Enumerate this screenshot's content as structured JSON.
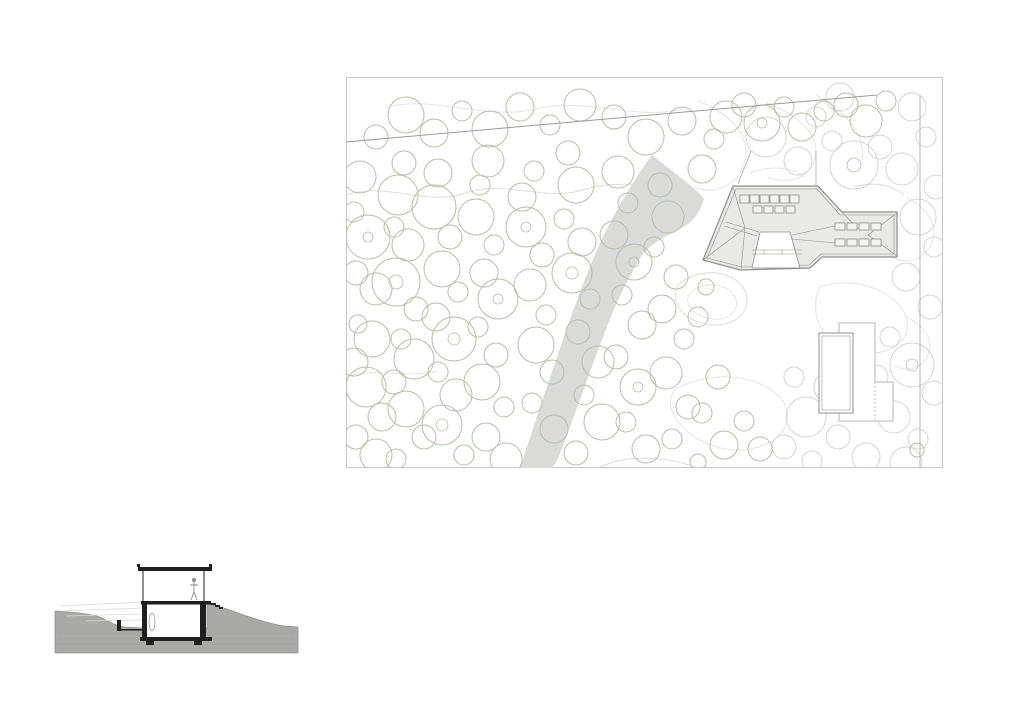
{
  "sheet": {
    "background": "#ffffff",
    "description_site_plan": "site-plan-with-trees-contours-driveway-buildings",
    "description_section": "building-cross-section-in-terrain"
  },
  "site_plan": {
    "colors": {
      "frame": "#c6c6c4",
      "contour": "#e4e4e0",
      "contour_dark": "#dcdcd8",
      "tree_green": "#b3c1a7",
      "tree_gray": "#d4d4d0",
      "driveway": "#dadad8",
      "building_fill": "#e9e9e7",
      "building_stroke": "#8f8f8d",
      "boundary": "#9a9a98",
      "thin_gray": "#b5b5b1",
      "skylight_fill": "#f4f4f2",
      "skylight_stroke": "#8d8d8b",
      "white": "#ffffff"
    },
    "frame_rect": [
      0.5,
      0.5,
      596,
      390
    ],
    "boundary_line": {
      "x1": 0,
      "y1": 65,
      "x2": 531,
      "y2": 18
    },
    "right_line": {
      "x1": 574,
      "y1": 18,
      "x2": 574,
      "y2": 391
    },
    "survey_circle": [
      571,
      373,
      7
    ],
    "driveway_path": "M 306 78 C 316 86 324 92 334 100 C 344 108 352 114 358 122 C 354 136 346 146 334 152 C 320 159 306 166 296 178 C 282 200 268 230 254 268 C 240 306 224 350 212 382 L 206 391 L 174 391 C 186 354 202 306 220 254 C 236 208 250 172 264 146 C 278 120 292 97 306 78 Z",
    "contours": [
      "M 0 118 C 40 104 80 130 120 116 C 160 102 200 126 240 112 C 272 102 300 112 330 104",
      "M 40 30 C 90 18 140 44 190 32 C 240 20 290 44 336 32",
      "M 352 24 C 392 40 408 66 396 92 C 388 110 366 118 348 110",
      "M 420 26 C 458 40 476 62 468 84 C 462 102 440 108 422 100",
      "M 470 18 C 500 34 520 58 516 84",
      "M 332 208 C 352 190 386 192 398 212 C 408 230 392 250 366 248 C 342 246 322 228 332 208 Z",
      "M 344 216 C 358 204 380 206 388 218 C 396 232 384 244 366 242 C 350 240 336 228 344 216 Z",
      "M 560 120 C 584 132 594 152 584 170 C 574 186 552 188 540 176",
      "M 474 210 C 506 200 540 210 556 232 C 570 252 556 274 528 276 C 498 278 472 258 470 236 C 469 224 470 216 474 210 Z",
      "M 330 312 C 362 294 408 296 432 318 C 452 338 440 366 404 372 C 368 378 334 356 326 334 C 323 325 324 318 330 312 Z",
      "M 252 391 C 282 376 322 380 352 391",
      "M 448 160 C 470 150 492 152 506 164",
      "M 404 96 C 424 88 446 90 458 100",
      "M 0 300 C 30 290 60 302 92 294",
      "M 560 240 C 578 248 588 262 582 278 C 576 292 560 296 548 288",
      "M 508 110 C 528 104 546 108 558 118"
    ],
    "trees_green": [
      [
        14,
        100,
        16
      ],
      [
        8,
        135,
        10
      ],
      [
        22,
        160,
        22
      ],
      [
        10,
        196,
        12
      ],
      [
        30,
        212,
        16
      ],
      [
        12,
        247,
        9
      ],
      [
        26,
        262,
        18
      ],
      [
        8,
        285,
        14
      ],
      [
        20,
        310,
        20
      ],
      [
        36,
        340,
        14
      ],
      [
        10,
        360,
        12
      ],
      [
        30,
        378,
        16
      ],
      [
        52,
        118,
        20
      ],
      [
        58,
        86,
        12
      ],
      [
        48,
        150,
        10
      ],
      [
        62,
        168,
        16
      ],
      [
        50,
        205,
        24
      ],
      [
        70,
        232,
        12
      ],
      [
        55,
        262,
        10
      ],
      [
        68,
        282,
        20
      ],
      [
        48,
        305,
        12
      ],
      [
        60,
        332,
        18
      ],
      [
        78,
        360,
        12
      ],
      [
        50,
        382,
        10
      ],
      [
        92,
        96,
        14
      ],
      [
        88,
        130,
        22
      ],
      [
        104,
        160,
        12
      ],
      [
        96,
        192,
        18
      ],
      [
        112,
        215,
        10
      ],
      [
        90,
        240,
        14
      ],
      [
        108,
        262,
        22
      ],
      [
        92,
        295,
        10
      ],
      [
        110,
        318,
        16
      ],
      [
        96,
        348,
        20
      ],
      [
        118,
        378,
        10
      ],
      [
        134,
        108,
        10
      ],
      [
        142,
        84,
        16
      ],
      [
        130,
        140,
        18
      ],
      [
        148,
        168,
        10
      ],
      [
        138,
        196,
        14
      ],
      [
        152,
        222,
        20
      ],
      [
        132,
        250,
        10
      ],
      [
        150,
        278,
        12
      ],
      [
        136,
        305,
        18
      ],
      [
        158,
        330,
        10
      ],
      [
        140,
        360,
        14
      ],
      [
        160,
        382,
        16
      ],
      [
        176,
        120,
        14
      ],
      [
        188,
        94,
        10
      ],
      [
        180,
        150,
        20
      ],
      [
        196,
        178,
        12
      ],
      [
        184,
        208,
        16
      ],
      [
        200,
        238,
        10
      ],
      [
        190,
        268,
        18
      ],
      [
        206,
        295,
        12
      ],
      [
        186,
        326,
        10
      ],
      [
        208,
        352,
        14
      ],
      [
        222,
        76,
        12
      ],
      [
        230,
        108,
        18
      ],
      [
        218,
        142,
        10
      ],
      [
        236,
        165,
        14
      ],
      [
        226,
        196,
        20
      ],
      [
        244,
        222,
        10
      ],
      [
        232,
        255,
        12
      ],
      [
        252,
        285,
        16
      ],
      [
        238,
        318,
        10
      ],
      [
        256,
        345,
        18
      ],
      [
        230,
        376,
        12
      ],
      [
        272,
        95,
        16
      ],
      [
        282,
        126,
        10
      ],
      [
        268,
        158,
        14
      ],
      [
        288,
        185,
        18
      ],
      [
        276,
        218,
        10
      ],
      [
        296,
        248,
        14
      ],
      [
        270,
        280,
        12
      ],
      [
        292,
        310,
        18
      ],
      [
        280,
        345,
        10
      ],
      [
        300,
        372,
        14
      ],
      [
        314,
        108,
        12
      ],
      [
        322,
        140,
        16
      ],
      [
        308,
        170,
        10
      ],
      [
        330,
        200,
        12
      ],
      [
        316,
        232,
        14
      ],
      [
        338,
        262,
        10
      ],
      [
        320,
        296,
        16
      ],
      [
        342,
        330,
        12
      ],
      [
        326,
        362,
        10
      ],
      [
        356,
        92,
        14
      ],
      [
        368,
        62,
        10
      ],
      [
        380,
        40,
        16
      ],
      [
        398,
        28,
        12
      ],
      [
        416,
        46,
        18
      ],
      [
        438,
        30,
        10
      ],
      [
        456,
        50,
        14
      ],
      [
        478,
        34,
        10
      ],
      [
        352,
        240,
        10
      ],
      [
        360,
        210,
        8
      ],
      [
        372,
        300,
        12
      ],
      [
        356,
        336,
        10
      ],
      [
        378,
        368,
        14
      ],
      [
        398,
        344,
        10
      ],
      [
        414,
        372,
        12
      ],
      [
        352,
        385,
        8
      ],
      [
        500,
        28,
        12
      ],
      [
        520,
        44,
        16
      ],
      [
        540,
        24,
        10
      ],
      [
        300,
        60,
        18
      ],
      [
        268,
        40,
        12
      ],
      [
        234,
        28,
        16
      ],
      [
        204,
        48,
        10
      ],
      [
        174,
        30,
        14
      ],
      [
        144,
        52,
        18
      ],
      [
        116,
        34,
        10
      ],
      [
        88,
        56,
        14
      ],
      [
        60,
        38,
        18
      ],
      [
        30,
        60,
        12
      ],
      [
        336,
        44,
        14
      ]
    ],
    "trees_gray": [
      [
        420,
        60,
        20
      ],
      [
        452,
        84,
        14
      ],
      [
        486,
        64,
        10
      ],
      [
        508,
        88,
        24
      ],
      [
        534,
        70,
        12
      ],
      [
        556,
        92,
        16
      ],
      [
        580,
        60,
        10
      ],
      [
        566,
        30,
        14
      ],
      [
        590,
        110,
        12
      ],
      [
        572,
        140,
        18
      ],
      [
        588,
        170,
        10
      ],
      [
        560,
        200,
        14
      ],
      [
        584,
        230,
        12
      ],
      [
        544,
        260,
        10
      ],
      [
        566,
        288,
        22
      ],
      [
        588,
        316,
        12
      ],
      [
        548,
        340,
        16
      ],
      [
        572,
        362,
        10
      ],
      [
        520,
        380,
        14
      ],
      [
        492,
        360,
        12
      ],
      [
        466,
        384,
        10
      ],
      [
        508,
        330,
        10
      ],
      [
        484,
        310,
        16
      ],
      [
        460,
        340,
        20
      ],
      [
        438,
        370,
        12
      ],
      [
        448,
        300,
        10
      ],
      [
        530,
        300,
        12
      ],
      [
        560,
        386,
        16
      ],
      [
        470,
        40,
        10
      ],
      [
        494,
        20,
        14
      ]
    ],
    "trunks": [
      [
        22,
        160,
        5
      ],
      [
        50,
        205,
        7
      ],
      [
        108,
        262,
        6
      ],
      [
        180,
        150,
        5
      ],
      [
        226,
        196,
        6
      ],
      [
        288,
        185,
        5
      ],
      [
        96,
        348,
        6
      ],
      [
        566,
        288,
        6
      ],
      [
        152,
        222,
        5
      ],
      [
        292,
        310,
        5
      ],
      [
        416,
        46,
        5
      ],
      [
        508,
        88,
        7
      ]
    ],
    "main_building": {
      "outline": "M 357 183 L 387 109 L 472 109 L 496 135 L 551 135 L 551 180 L 476 180 L 464 191 L 394 193 Z",
      "inner": "M 361 181 L 390 112 L 471 112 L 494 138 L 548 138 L 548 177 L 475 177 L 463 188 L 396 190 Z",
      "courtyard": "M 406 191 L 414 155 L 444 155 L 454 191 Z",
      "roof_lines": [
        "M 551 136 L 522 158 L 551 179",
        "M 496 135 L 512 152",
        "M 357 183 L 399 151",
        "M 387 110 L 399 151",
        "M 399 151 L 395 192",
        "M 380 145 L 413 155",
        "M 378 149 L 411 159",
        "M 446 158 L 489 149",
        "M 446 162 L 489 166",
        "M 406 173 L 456 173",
        "M 406 177 L 456 177",
        "M 418 173 L 418 177",
        "M 436 173 L 436 177",
        "M 405 74 L 392 107",
        "M 470 74 L 470 108"
      ],
      "skylights": [
        [
          394,
          118,
          9,
          8
        ],
        [
          404,
          118,
          9,
          8
        ],
        [
          414,
          118,
          9,
          8
        ],
        [
          424,
          118,
          9,
          8
        ],
        [
          434,
          118,
          9,
          8
        ],
        [
          444,
          118,
          9,
          8
        ],
        [
          407,
          129,
          9,
          7
        ],
        [
          418,
          129,
          9,
          7
        ],
        [
          429,
          129,
          9,
          7
        ],
        [
          440,
          129,
          9,
          7
        ],
        [
          489,
          146,
          10,
          7
        ],
        [
          501,
          146,
          10,
          7
        ],
        [
          513,
          146,
          10,
          7
        ],
        [
          525,
          146,
          10,
          7
        ],
        [
          489,
          162,
          10,
          7
        ],
        [
          501,
          162,
          10,
          7
        ],
        [
          513,
          162,
          10,
          7
        ],
        [
          525,
          162,
          10,
          7
        ]
      ]
    },
    "pool_house": {
      "l_shape": "M 493 246 L 529 246 L 529 305 L 547 305 L 547 344 L 493 344 Z",
      "dashed_rect": [
        529,
        305,
        18,
        39
      ],
      "pool_outer": [
        473,
        256,
        34,
        80
      ],
      "pool_inner": [
        476,
        259,
        28,
        74
      ]
    }
  },
  "section": {
    "colors": {
      "ground": "#a9a9a7",
      "ground_edge": "#939391",
      "ink": "#1f1f1f",
      "figure": "#8a8a88",
      "light": "#d8d8d6",
      "object": "#9a9a98",
      "white": "#ffffff"
    },
    "ground_path": "M 25 71 C 45 72 60 74 70 77 C 80 82 86 86 94 87 L 112 88 L 177 88 L 177 64 C 188 66 198 69 208 73 C 222 78 240 84 254 86 L 268 87 L 268 113 L 25 113 Z",
    "hatch_lines": [
      "M 28 94 L 264 94",
      "M 28 99 L 264 99",
      "M 28 104 L 264 104",
      "M 30 109 L 262 109"
    ],
    "sight_lines": [
      "M 30 66 L 112 62",
      "M 32 71 L 112 68",
      "M 36 76 L 112 74",
      "M 56 81 L 112 80"
    ],
    "white_rects": [
      [
        114,
        31,
        60,
        30
      ],
      [
        117,
        64,
        53,
        33
      ]
    ],
    "ink_rects": [
      [
        108,
        27,
        74,
        4
      ],
      [
        107,
        24,
        3,
        3
      ],
      [
        179,
        24,
        3,
        3
      ],
      [
        111,
        61,
        70,
        3.5
      ],
      [
        181,
        63,
        5,
        2
      ],
      [
        185,
        65,
        5,
        2
      ],
      [
        189,
        67,
        4,
        2
      ],
      [
        112,
        64,
        5,
        33
      ],
      [
        170,
        64,
        6,
        33
      ],
      [
        110,
        97,
        72,
        4
      ],
      [
        116,
        101,
        8,
        4
      ],
      [
        164,
        101,
        8,
        4
      ],
      [
        87,
        80,
        4,
        11
      ],
      [
        87,
        89,
        25,
        1.5
      ]
    ],
    "wall_lines": [
      "M 113 31 L 113 61",
      "M 174 31 L 174 61"
    ],
    "figure_head": [
      164,
      40,
      2
    ],
    "figure_body": "M 164 42 L 164 52 M 160 45 L 168 45 M 164 52 L 161 60 M 164 52 L 167 60",
    "lamp_ellipse": [
      122,
      82,
      3,
      9
    ]
  }
}
